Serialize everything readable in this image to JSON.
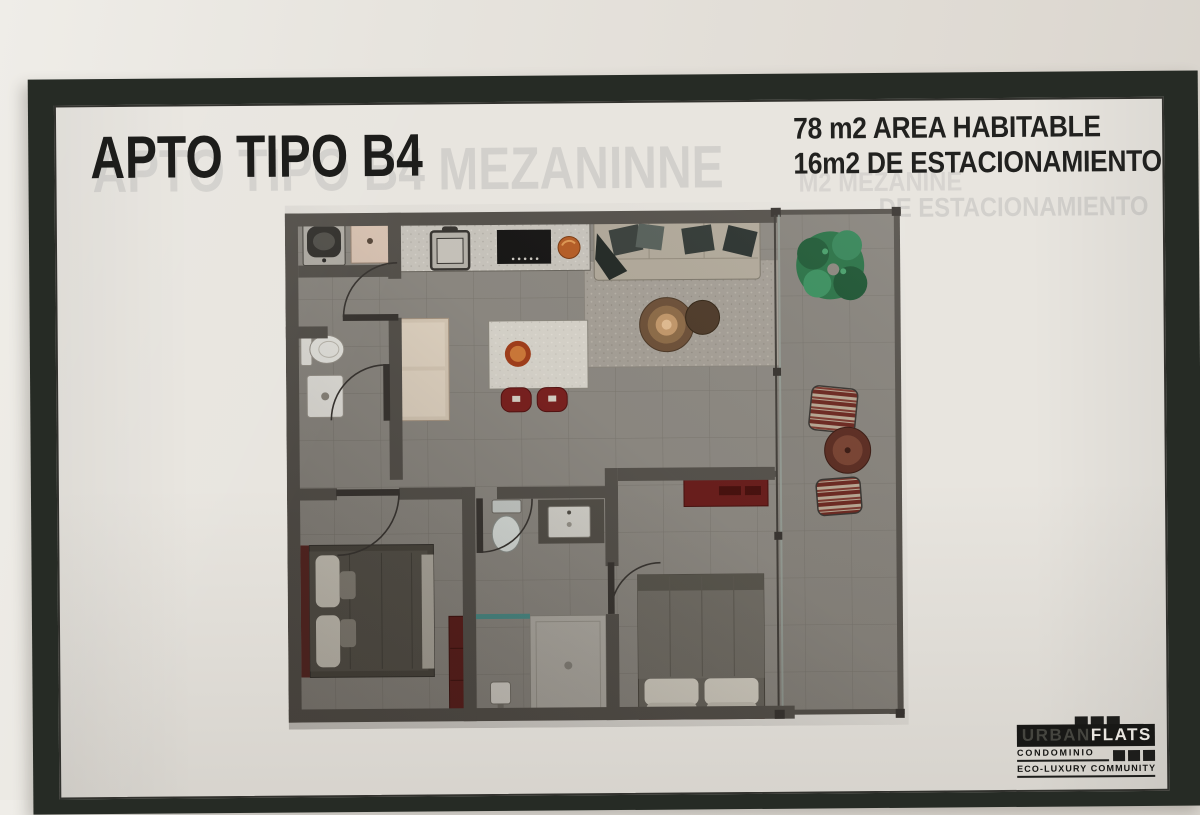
{
  "poster": {
    "title": "APTO TIPO B4",
    "ghost_title": "APTO TIPO B4 MEZANINNE",
    "area_line1": "78 m2 AREA HABITABLE",
    "area_line2": "16m2 DE ESTACIONAMIENTO",
    "ghost_area_line1": "M2 MEZANINE",
    "ghost_area_line2": "DE ESTACIONAMIENTO",
    "logo": {
      "brand_urban": "URBAN",
      "brand_flats": "FLATS",
      "subtitle": "CONDOMINIO",
      "tagline": "ECO-LUXURY COMMUNITY"
    },
    "colors": {
      "frame": "#262b25",
      "paper": "#e8e5df",
      "plan_wall": "#57534d",
      "plan_floor": "#8e8a83",
      "accent_red": "#7c2220",
      "accent_orange": "#b85f27",
      "plant_green": "#2c7448",
      "glass_teal": "#4d8f8a"
    },
    "floor_plan_items": [
      "washer",
      "laundry-sink",
      "kitchen-sink",
      "cooktop",
      "fruit-bowl",
      "dining-table",
      "dining-chairs",
      "wardrobe",
      "toilet",
      "bathroom-sink",
      "sofa",
      "area-rug",
      "coffee-tables",
      "balcony-plant",
      "lounge-chairs",
      "patio-table",
      "bed",
      "shower",
      "vanity",
      "console"
    ]
  }
}
